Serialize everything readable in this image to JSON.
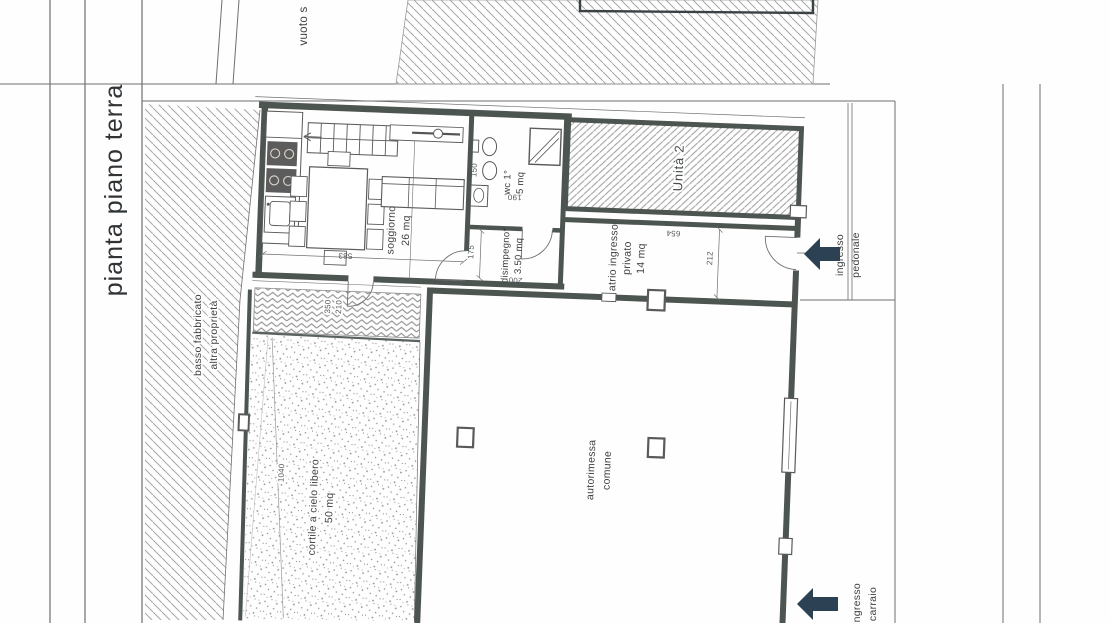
{
  "sheet": {
    "title": "pianta piano terra"
  },
  "upper_fragment": {
    "label": "vuoto s"
  },
  "rooms": {
    "soggiorno": {
      "name": "soggiorno",
      "area": "26 mq"
    },
    "wc": {
      "name": "wc 1°",
      "area": "5 mq"
    },
    "disimpegno": {
      "name": "disimpegno*",
      "area": "3.50 mq"
    },
    "atrio": {
      "name": "atrio ingresso",
      "name2": "privato",
      "area": "14 mq"
    },
    "unita2": {
      "name": "Unità 2"
    },
    "autorimessa": {
      "name": "autorimessa",
      "name2": "comune"
    },
    "cortile": {
      "name": "cortile a cielo libero",
      "area": "50 mq"
    }
  },
  "adjacent": {
    "basso1": "basso fabbricato",
    "basso2": "altra proprietà"
  },
  "entrances": {
    "pedonale1": "ingresso",
    "pedonale2": "pedonale",
    "carraio1": "ingresso",
    "carraio2": "carraio"
  },
  "dimensions": {
    "soggiorno_w": "583",
    "paving_a": "350",
    "paving_b": "210",
    "cortile_l": "1040",
    "disimpegno_w": "175",
    "disimpegno_l": "200",
    "wc_w": "150",
    "wc_l": "190",
    "atrio_l": "654",
    "atrio_w": "212"
  },
  "colors": {
    "wall": "#4d5551",
    "arrow": "#2c4153",
    "text": "#3b3f41",
    "hatch": "#a6a6a6"
  }
}
